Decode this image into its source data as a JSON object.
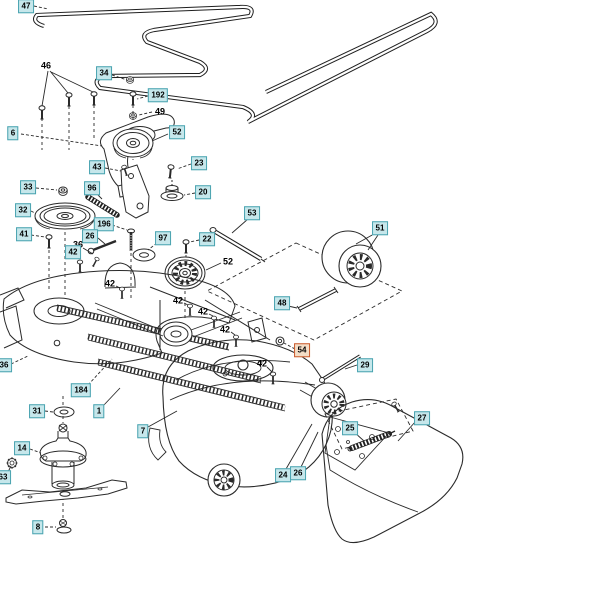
{
  "diagram": {
    "type": "exploded-parts-diagram",
    "subject": "mower deck assembly",
    "background": "#ffffff",
    "line_color": "#2a2a2a",
    "label_styles": {
      "box": {
        "bg": "#c6e7eb",
        "border": "#49a3b0",
        "text": "#000000"
      },
      "highlight": {
        "bg": "#f3ddc6",
        "border": "#cb5a2c",
        "text": "#000000"
      },
      "plain": {
        "bg": "",
        "border": "",
        "text": "#000000"
      }
    }
  },
  "labels": [
    {
      "num": "47",
      "x": 26,
      "y": 6,
      "style": "box"
    },
    {
      "num": "46",
      "x": 46,
      "y": 66,
      "style": "plain"
    },
    {
      "num": "34",
      "x": 104,
      "y": 73,
      "style": "box"
    },
    {
      "num": "192",
      "x": 158,
      "y": 95,
      "style": "box"
    },
    {
      "num": "49",
      "x": 160,
      "y": 112,
      "style": "plain"
    },
    {
      "num": "6",
      "x": 13,
      "y": 133,
      "style": "box"
    },
    {
      "num": "52",
      "x": 177,
      "y": 132,
      "style": "box"
    },
    {
      "num": "43",
      "x": 97,
      "y": 167,
      "style": "box"
    },
    {
      "num": "23",
      "x": 199,
      "y": 163,
      "style": "box"
    },
    {
      "num": "33",
      "x": 28,
      "y": 187,
      "style": "box"
    },
    {
      "num": "96",
      "x": 92,
      "y": 188,
      "style": "box"
    },
    {
      "num": "20",
      "x": 203,
      "y": 192,
      "style": "box"
    },
    {
      "num": "32",
      "x": 23,
      "y": 210,
      "style": "box"
    },
    {
      "num": "53",
      "x": 252,
      "y": 213,
      "style": "box"
    },
    {
      "num": "196",
      "x": 104,
      "y": 224,
      "style": "box"
    },
    {
      "num": "51",
      "x": 380,
      "y": 228,
      "style": "box"
    },
    {
      "num": "41",
      "x": 24,
      "y": 234,
      "style": "box"
    },
    {
      "num": "26",
      "x": 90,
      "y": 236,
      "style": "box"
    },
    {
      "num": "97",
      "x": 163,
      "y": 238,
      "style": "box"
    },
    {
      "num": "22",
      "x": 207,
      "y": 239,
      "style": "box"
    },
    {
      "num": "36",
      "x": 78,
      "y": 245,
      "style": "plain"
    },
    {
      "num": "42",
      "x": 73,
      "y": 252,
      "style": "box"
    },
    {
      "num": "52",
      "x": 228,
      "y": 262,
      "style": "plain"
    },
    {
      "num": "42",
      "x": 110,
      "y": 284,
      "style": "plain"
    },
    {
      "num": "42",
      "x": 178,
      "y": 301,
      "style": "plain"
    },
    {
      "num": "48",
      "x": 282,
      "y": 303,
      "style": "box"
    },
    {
      "num": "42",
      "x": 203,
      "y": 312,
      "style": "plain"
    },
    {
      "num": "42",
      "x": 225,
      "y": 330,
      "style": "plain"
    },
    {
      "num": "54",
      "x": 302,
      "y": 350,
      "style": "highlight"
    },
    {
      "num": "36",
      "x": 4,
      "y": 365,
      "style": "box"
    },
    {
      "num": "42",
      "x": 262,
      "y": 364,
      "style": "plain"
    },
    {
      "num": "29",
      "x": 365,
      "y": 365,
      "style": "box"
    },
    {
      "num": "184",
      "x": 81,
      "y": 390,
      "style": "box"
    },
    {
      "num": "31",
      "x": 37,
      "y": 411,
      "style": "box"
    },
    {
      "num": "1",
      "x": 99,
      "y": 411,
      "style": "box"
    },
    {
      "num": "27",
      "x": 422,
      "y": 418,
      "style": "box"
    },
    {
      "num": "25",
      "x": 350,
      "y": 428,
      "style": "box"
    },
    {
      "num": "7",
      "x": 143,
      "y": 431,
      "style": "box"
    },
    {
      "num": "14",
      "x": 22,
      "y": 448,
      "style": "box"
    },
    {
      "num": "63",
      "x": 3,
      "y": 477,
      "style": "box"
    },
    {
      "num": "24",
      "x": 283,
      "y": 475,
      "style": "box"
    },
    {
      "num": "26",
      "x": 298,
      "y": 473,
      "style": "box"
    },
    {
      "num": "8",
      "x": 38,
      "y": 527,
      "style": "box"
    }
  ]
}
